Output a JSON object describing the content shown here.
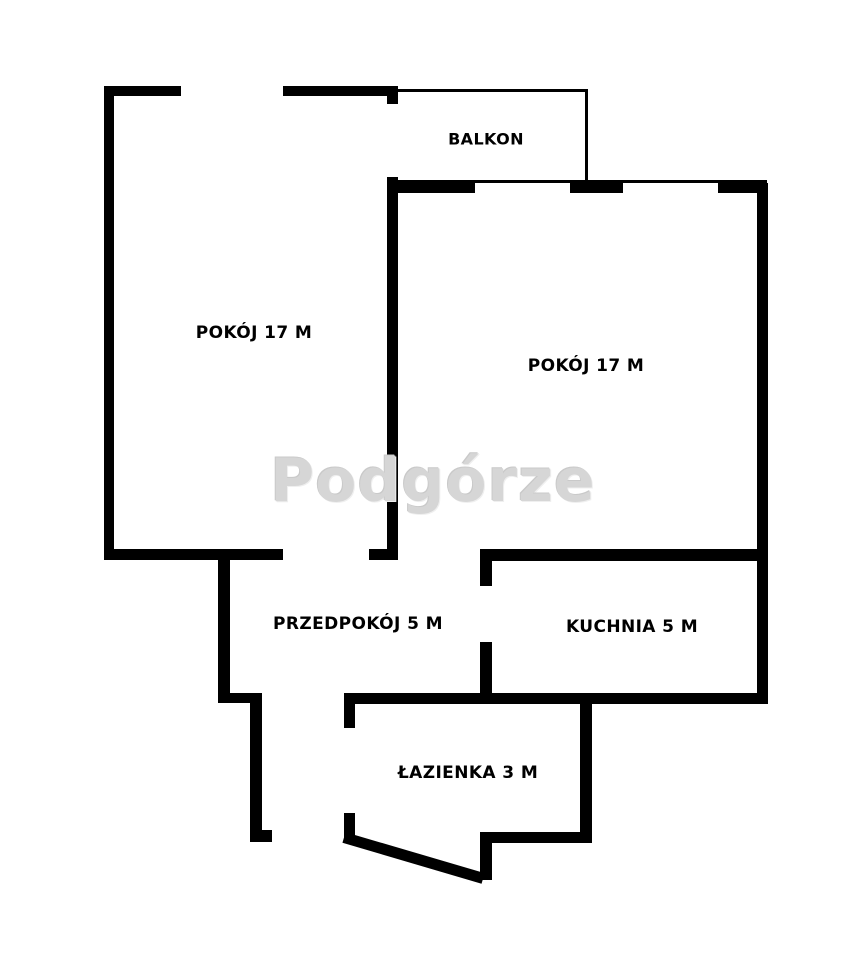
{
  "plan": {
    "watermark": "Podgórze",
    "colors": {
      "wall": "#000000",
      "background": "#ffffff",
      "watermark": "#d6d6d6"
    }
  },
  "rooms": {
    "balkon": {
      "label": "BALKON"
    },
    "pokoj_left": {
      "label": "POKÓJ 17 M",
      "name": "POKÓJ",
      "area": "17 M"
    },
    "pokoj_right": {
      "label": "POKÓJ 17 M",
      "name": "POKÓJ",
      "area": "17 M"
    },
    "przedpokoj": {
      "label": "PRZEDPOKÓJ 5 M",
      "name": "PRZEDPOKÓJ",
      "area": "5 M"
    },
    "kuchnia": {
      "label": "KUCHNIA 5 M",
      "name": "KUCHNIA",
      "area": "5 M"
    },
    "lazienka": {
      "label": "ŁAZIENKA 3 M",
      "name": "ŁAZIENKA",
      "area": "3 M"
    }
  }
}
